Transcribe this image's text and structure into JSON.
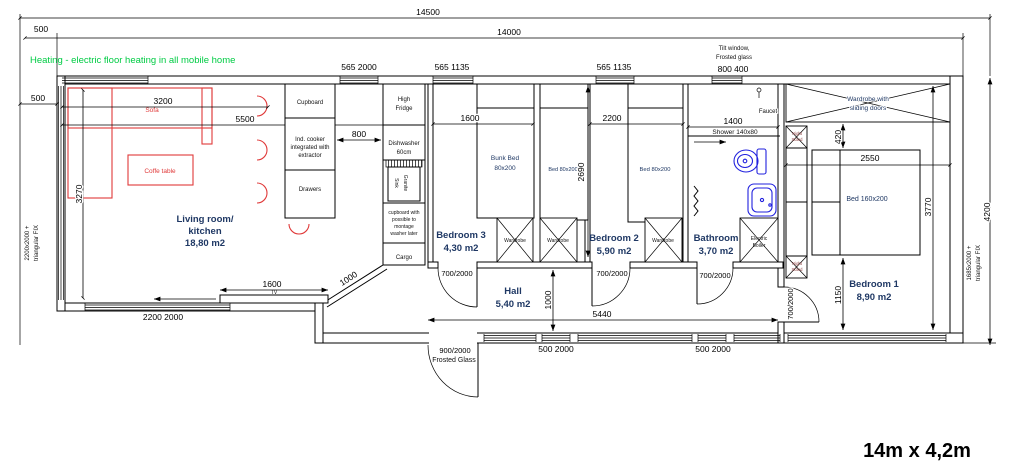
{
  "title": "14m x 4,2m",
  "note": "Heating - electric floor heating in all mobile home",
  "colors": {
    "furniture": "#e03a3a",
    "fixtures": "#2121de",
    "note": "#00cc44",
    "room_label": "#1f3864",
    "line": "#000000"
  },
  "dims": {
    "overall_top": "14500",
    "inner_top": "14000",
    "top_left_offset": "500",
    "left_wall": "500",
    "sofa": "3200",
    "living_w": "5500",
    "living_h": "3270",
    "counter_gap": "800",
    "bed3_w": "1600",
    "bed2_w": "2200",
    "beds_h": "2690",
    "bath_w": "1400",
    "hall_h": "1000",
    "hall_w": "5440",
    "tv_w": "1600",
    "diag": "1000",
    "ward_gap": "420",
    "bed1_w": "2550",
    "bed1_h": "3770",
    "bed1_off": "1150",
    "overall_right": "4200"
  },
  "windows": {
    "top1": "565 2000",
    "top2": "565 1135",
    "top3": "565 1135",
    "top4": "800 400",
    "tilt1": "Tilt window,",
    "tilt2": "Frosted glass",
    "left1": "2200x2000 +",
    "left2": "triangular FIX",
    "right1": "1685x2000 +",
    "right2": "triangular FIX",
    "bottom_living": "2200 2000",
    "bottom_hall": "500 2000",
    "bottom_bath": "500 2000"
  },
  "doors": {
    "b3": "700/2000",
    "b2": "700/2000",
    "bath": "700/2000",
    "b1": "700/2000",
    "entry1": "900/2000",
    "entry2": "Frosted Glass"
  },
  "rooms": {
    "living": [
      "Living room/",
      "kitchen",
      "18,80 m2"
    ],
    "b3": [
      "Bedroom 3",
      "4,30 m2"
    ],
    "b2": [
      "Bedroom 2",
      "5,90 m2"
    ],
    "bath": [
      "Bathroom",
      "3,70 m2"
    ],
    "hall": [
      "Hall",
      "5,40 m2"
    ],
    "b1": [
      "Bedroom 1",
      "8,90 m2"
    ]
  },
  "kitchen": {
    "cupboard": "Cupboard",
    "cooker": [
      "Ind. cooker",
      "integrated with",
      "extractor"
    ],
    "drawers": "Drawers",
    "fridge": [
      "High",
      "Fridge"
    ],
    "dw": [
      "Dishwasher",
      "60cm"
    ],
    "sink": [
      "Granite",
      "Sink"
    ],
    "washer": [
      "cupboard with",
      "possible to",
      "montage",
      "washer later"
    ],
    "cargo": "Cargo"
  },
  "furniture": {
    "sofa": "Sofa",
    "coffee": "Coffe table",
    "tv": "TV",
    "bunk": [
      "Bunk Bed",
      "80x200"
    ],
    "bed3": "Bed 80x200",
    "bed2": "Bed 80x200",
    "wardrobe": "Wardrobe",
    "ward_slide": [
      "Wardrobe with",
      "sliding doors"
    ],
    "bed1": "Bed 160x200",
    "night": [
      "Night",
      "Stand"
    ],
    "boiler": [
      "Electric",
      "Boiler"
    ]
  },
  "bath_items": {
    "shower": "Shower 140x80",
    "faucet": "Faucet"
  }
}
